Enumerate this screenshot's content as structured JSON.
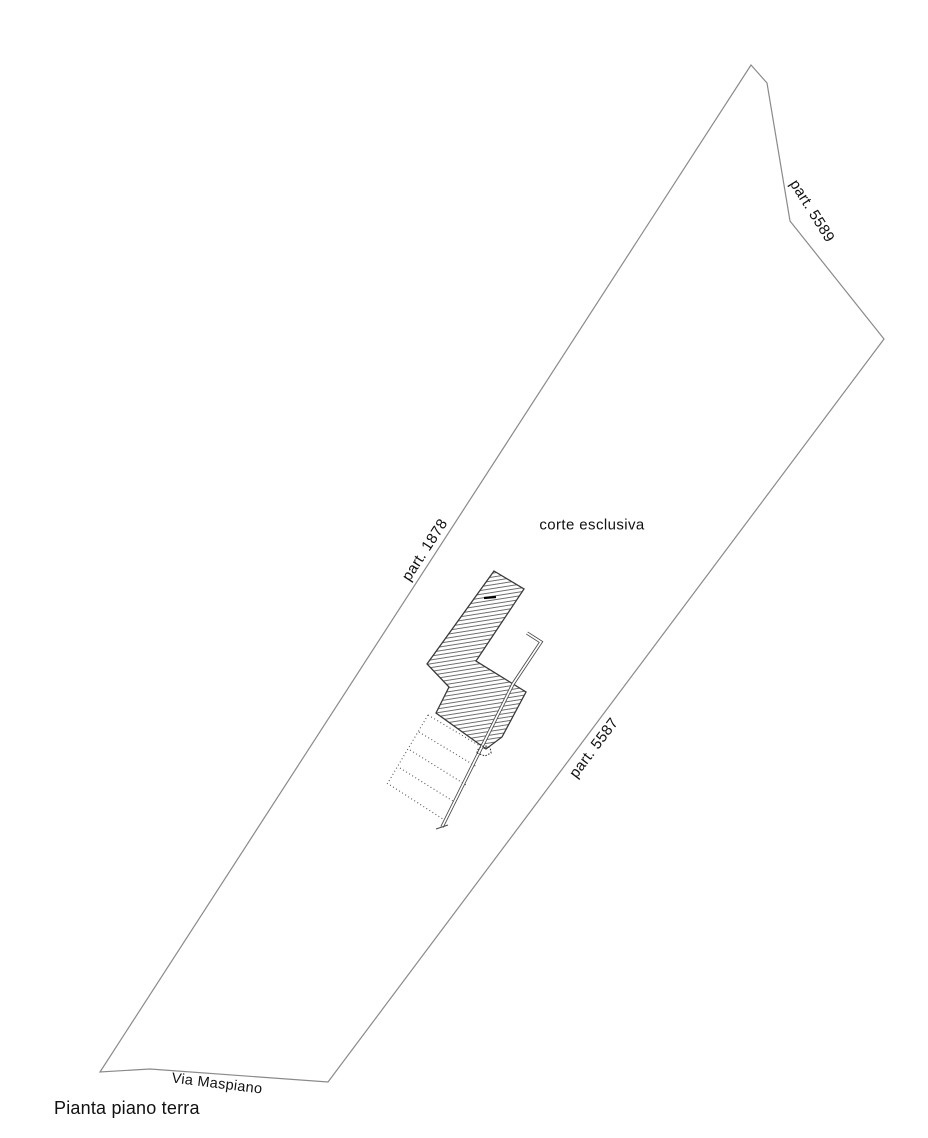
{
  "plan": {
    "title": "Pianta piano terra",
    "labels": {
      "parcel_ne": "part. 5589",
      "parcel_w": "part. 1878",
      "parcel_se": "part. 5587",
      "courtyard": "corte esclusiva",
      "street": "Via Maspiano"
    },
    "colors": {
      "background": "#ffffff",
      "parcel_boundary": "#8a8a8a",
      "building_outline": "#3a3a3a",
      "hatch_lines": "#5f5f5f",
      "dotted_lines": "#555555",
      "text": "#111111"
    }
  }
}
